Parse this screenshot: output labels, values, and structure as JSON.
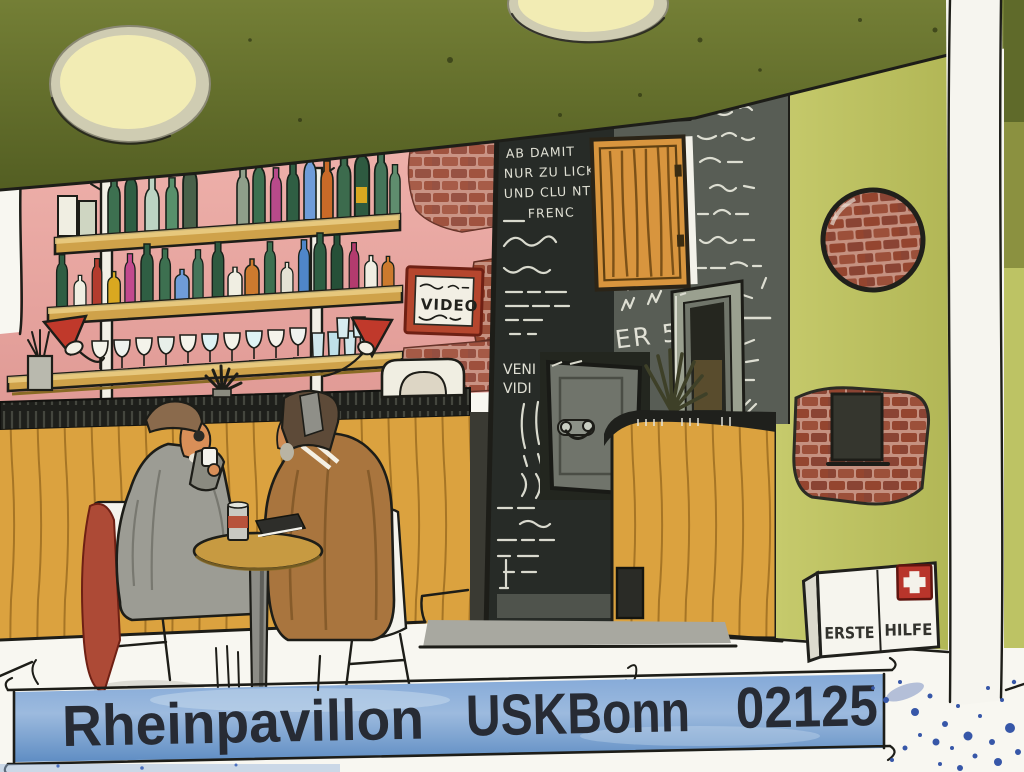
{
  "artwork": {
    "kind": "watercolor-and-ink urban sketch",
    "subject": "Interior of a bar: two men talking at a small table in front of a wooden counter, bottle shelves on a pink brick wall, chalkboards and a green wall",
    "banner": {
      "venue": "Rheinpavillon",
      "group": "USKBonn",
      "number": "02125"
    },
    "signs": {
      "video": "VIDEO",
      "beer_price": "BIER 5€",
      "latin_1": "VENI",
      "latin_2": "VIDI",
      "first_aid_1": "ERSTE",
      "first_aid_2": "HILFE"
    },
    "chalk_scrawl": [
      "AB DAMIT",
      "NUR ZU LICK",
      "UND CLU NT",
      "FRENC"
    ],
    "palette": {
      "ceiling_olive": "#66702c",
      "wall_pink": "#e9a7a2",
      "wall_green": "#c2c766",
      "wood": "#dba23f",
      "chalkboard_dark": "#2a2e2a",
      "chalkboard_gray": "#585d55",
      "banner_blue": "#6f9cd2",
      "lamp_red": "#c0392b",
      "brick_red": "#94452f"
    }
  }
}
